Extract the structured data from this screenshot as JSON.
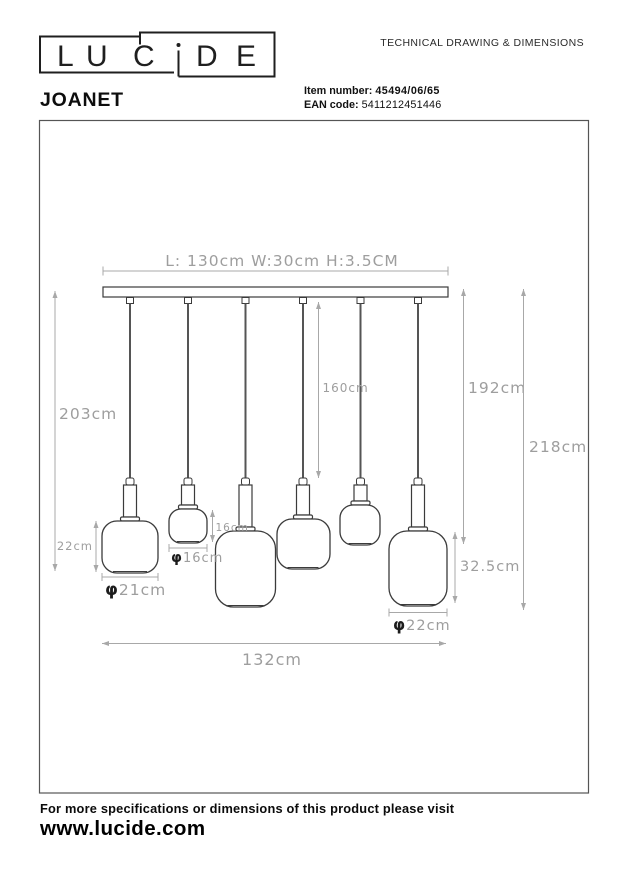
{
  "header": {
    "brand_name": "LUCIDE",
    "brand_letters": [
      "L",
      "U",
      "C",
      "D",
      "E"
    ],
    "doc_title": "TECHNICAL DRAWING & DIMENSIONS",
    "product_name": "JOANET",
    "item_number_label": "Item number:",
    "item_number_value": "45494/06/65",
    "ean_label": "EAN code:",
    "ean_value": "5411212451446"
  },
  "drawing": {
    "fixture_size_label": "L: 130cm W:30cm H:3.5CM",
    "dim_total_left": "203cm",
    "dim_cord_inner": "160cm",
    "dim_right_inner": "192cm",
    "dim_right_outer": "218cm",
    "dim_shade1_height": "22cm",
    "dim_shade2_height": "16cm",
    "dim_shade6_height": "32.5cm",
    "dim_spread": "132cm",
    "dia_symbol": "φ",
    "dia_shade1": "21cm",
    "dia_shade2": "16cm",
    "dia_shade6": "22cm"
  },
  "footer": {
    "note": "For more specifications or dimensions of this product please visit",
    "website": "www.lucide.com"
  }
}
